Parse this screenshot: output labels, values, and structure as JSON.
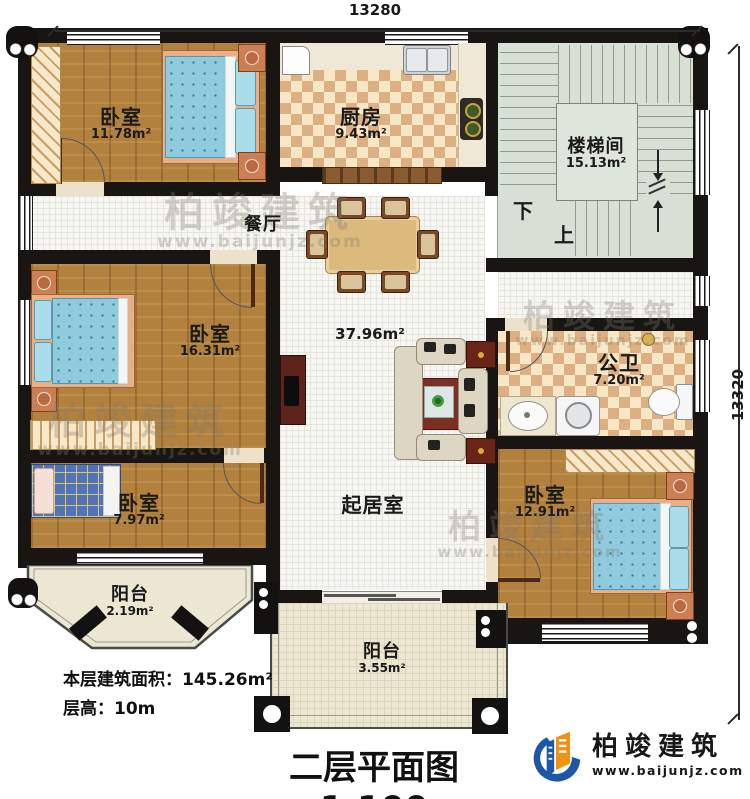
{
  "plan": {
    "title": "二层平面图1:100",
    "footer": {
      "area_line": "本层建筑面积：145.26m²",
      "height_line": "层高：10m"
    }
  },
  "dimensions": {
    "top": "13280",
    "right": "13320"
  },
  "rooms": {
    "bedroom_tl": {
      "name": "卧室",
      "area": "11.78m²"
    },
    "kitchen": {
      "name": "厨房",
      "area": "9.43m²"
    },
    "stairwell": {
      "name": "楼梯间",
      "area": "15.13m²"
    },
    "dining": {
      "name": "餐厅"
    },
    "bedroom_ml": {
      "name": "卧室",
      "area": "16.31m²"
    },
    "living": {
      "name": "起居室",
      "area": "37.96m²"
    },
    "bathroom": {
      "name": "公卫",
      "area": "7.20m²"
    },
    "bedroom_bl": {
      "name": "卧室",
      "area": "7.97m²"
    },
    "bedroom_br": {
      "name": "卧室",
      "area": "12.91m²"
    },
    "balcony_left": {
      "name": "阳台",
      "area": "2.19m²"
    },
    "balcony_bottom": {
      "name": "阳台",
      "area": "3.55m²"
    }
  },
  "stairs": {
    "down": "下",
    "up": "上"
  },
  "branding": {
    "name": "柏竣建筑",
    "url": "www.baijunjz.com"
  },
  "watermark": {
    "name": "柏竣建筑",
    "url": "www.baijunjz.com"
  },
  "colors": {
    "wall": "#181512",
    "wood": "#b3813e",
    "checker": "#ddb083",
    "stair": "#d8dfd5",
    "balcony": "#ece7d2",
    "logo_blue": "#1b57a6",
    "logo_orange": "#f29111"
  }
}
